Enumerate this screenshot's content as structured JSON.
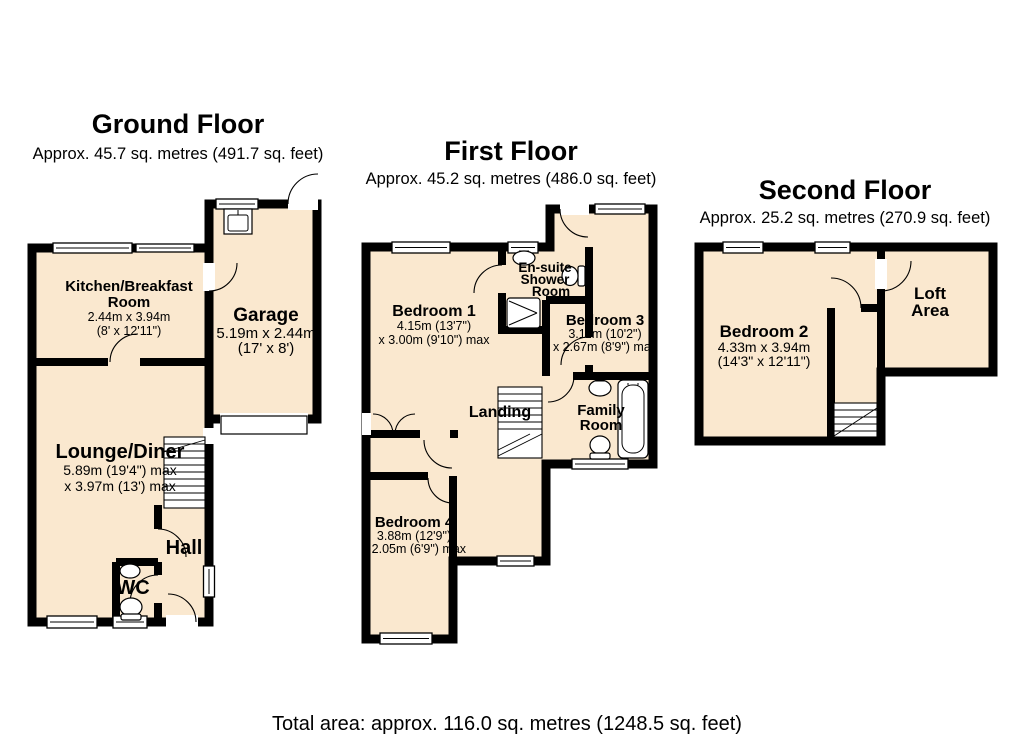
{
  "colors": {
    "room_fill": "#FAE8CF",
    "wall": "#000000"
  },
  "footer": {
    "total_area": "Total area: approx. 116.0 sq. metres (1248.5 sq. feet)"
  },
  "ground_floor": {
    "title": "Ground Floor",
    "area": "Approx. 45.7 sq. metres (491.7 sq. feet)",
    "rooms": {
      "kitchen": {
        "name_line1": "Kitchen/Breakfast",
        "name_line2": "Room",
        "dims_line1": "2.44m x 3.94m",
        "dims_line2": "(8' x 12'11\")"
      },
      "garage": {
        "name": "Garage",
        "dims_line1": "5.19m x 2.44m",
        "dims_line2": "(17' x 8')"
      },
      "lounge": {
        "name": "Lounge/Diner",
        "dims_line1": "5.89m (19'4\") max",
        "dims_line2": "x 3.97m (13') max"
      },
      "hall": {
        "name": "Hall"
      },
      "wc": {
        "name": "WC"
      }
    }
  },
  "first_floor": {
    "title": "First Floor",
    "area": "Approx. 45.2 sq. metres (486.0 sq. feet)",
    "rooms": {
      "bedroom1": {
        "name": "Bedroom 1",
        "dims_line1": "4.15m (13'7\")",
        "dims_line2": "x 3.00m (9'10\") max"
      },
      "ensuite": {
        "name_line1": "En-suite",
        "name_line2": "Shower",
        "name_line3": "Room"
      },
      "bedroom3": {
        "name": "Bedroom 3",
        "dims_line1": "3.11m (10'2\")",
        "dims_line2": "x 2.67m (8'9\") max"
      },
      "landing": {
        "name": "Landing"
      },
      "family": {
        "name_line1": "Family",
        "name_line2": "Room"
      },
      "bedroom4": {
        "name": "Bedroom 4",
        "dims_line1": "3.88m (12'9\")",
        "dims_line2": "x 2.05m (6'9\") max"
      }
    }
  },
  "second_floor": {
    "title": "Second Floor",
    "area": "Approx. 25.2 sq. metres (270.9 sq. feet)",
    "rooms": {
      "bedroom2": {
        "name": "Bedroom 2",
        "dims_line1": "4.33m x 3.94m",
        "dims_line2": "(14'3\" x 12'11\")"
      },
      "loft": {
        "name_line1": "Loft",
        "name_line2": "Area"
      }
    }
  }
}
